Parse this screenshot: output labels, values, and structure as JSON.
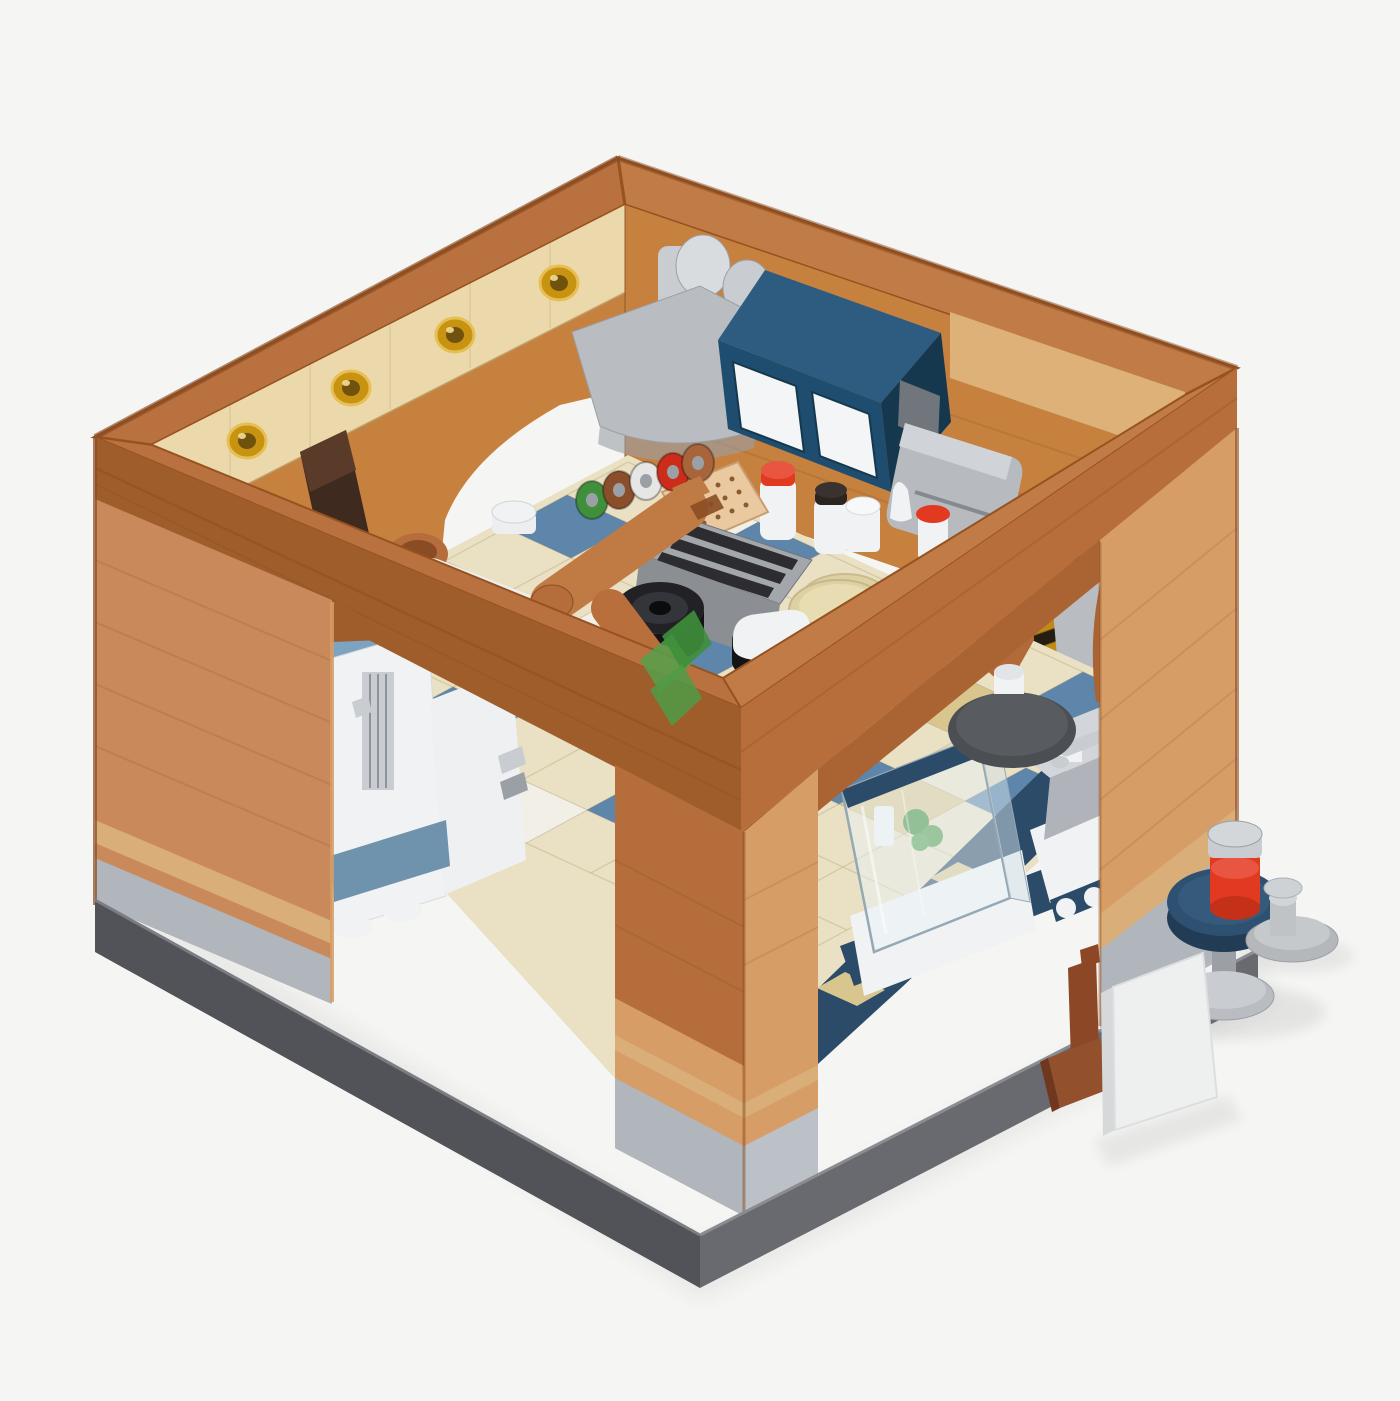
{
  "meta": {
    "alt": "3D product render of a LEGO-style modular building: an open-topped diner kitchen room with caramel brick walls, amber wall lamps, a dark-blue wall cabinet with white doors, chrome extractor hood and chimney, stove with black pots, robotic mixer arm, condiment bottles, glass display case, blue-and-cream checkered tile floor, and an outdoor round navy table with a red cup, a gray stool and a white menu board on a brown stand.",
    "caption": "Brick-built diner kitchen play set, isometric view on a light gray background. No text is visible in the image."
  },
  "palette": {
    "bg": "#f5f5f3",
    "rimTop": "#b97140",
    "rimTopLit": "#c17b46",
    "rimFaceL": "#9f5d2c",
    "rimFaceR": "#b86e3a",
    "rimSub": "#aa6434",
    "rimCap": "#96521f",
    "caramel": "#c9895a",
    "nougat": "#b66d3c",
    "nougatLight": "#d79d66",
    "tanBand": "#ecd9ab",
    "tanStripe": "#d9ae79",
    "tanUpper": "#ddb177",
    "intOrange": "#c6813f",
    "pillarGray": "#b1b6bc",
    "pillarGrayLite": "#bcc1c7",
    "stepGray": "#b9bdc2",
    "grayMid": "#9aa0a6",
    "grayDark": "#70767c",
    "chrome": "#c9ccd0",
    "chromeLite": "#d9dcdf",
    "cabBlue": "#1f4d70",
    "cabBlueTop": "#2e5c80",
    "cabBlueDk": "#15384f",
    "navy": "#2c4b68",
    "navyDk": "#223c55",
    "navyLite": "#2e5171",
    "doorWhite": "#f3f5f6",
    "white": "#f0f2f3",
    "whiteDim": "#e2e5e7",
    "stove": "#8b8e93",
    "stoveTop": "#a3a6ab",
    "stoveDk": "#54575c",
    "potBlack": "#222226",
    "potInner": "#34353b",
    "potDeep": "#141416",
    "cream": "#ddd1a4",
    "creamDk": "#c9bb8e",
    "creamLite": "#e7dcb2",
    "floorCream": "#eae1c4",
    "floorBlue": "#5d86aa",
    "floorWhite": "#f2efe7",
    "floorTan": "#d9c68f",
    "baseL": "#515358",
    "baseR": "#686a70",
    "baseLip": "#7b7d82",
    "blueTop": "#7da3c0",
    "blueTopDk": "#6f93ad",
    "cupRed": "#e23a20",
    "cupRedDk": "#c53118",
    "cupRedLite": "#e85540",
    "sign": "#eef0f0",
    "signSide": "#d6d8d9",
    "standBrown": "#8b4726",
    "standBrownDk": "#6f371d",
    "standBrownLite": "#93502c",
    "green": "#4f9b47",
    "greenDk": "#3f8f3b",
    "greenLite": "#55a04b",
    "amber": "#c89310",
    "amberDk": "#6f520d",
    "amberLite": "#e6bf55",
    "gold": "#c08a18",
    "goldDk": "#8f6410",
    "shutterDk": "#241d12",
    "bag": "#3f2a1f",
    "bagLite": "#5a3a28",
    "turn": "#4b4e53",
    "turnTop": "#585b60",
    "armWhite": "#eceef0",
    "armBrown": "#c07a44",
    "armBrownDk": "#8a4c22",
    "glass": "#e9f1f6",
    "glassSide": "#d4e1e9",
    "glassEdge": "#94a8b6"
  },
  "scene": {
    "objects": [
      "open-top brick room",
      "amber wall lamps",
      "hanging satchel",
      "extractor hood",
      "chimney pipes",
      "blue wall cabinet",
      "coffee machine",
      "condiment bottles",
      "plate rack",
      "strainer panel",
      "stove with pots",
      "mixer arm",
      "dough plate",
      "prep table",
      "bar stool",
      "plant",
      "drink machine",
      "glass display case",
      "sink counter with faucet",
      "turntable pedestal",
      "golden shutter",
      "checkered tile floor",
      "outdoor cafe table",
      "red cup",
      "outdoor stool",
      "menu board",
      "brown board stand"
    ]
  },
  "floor": {
    "origin": [
      628,
      462
    ],
    "u": [
      65,
      30
    ],
    "v": [
      -61,
      33
    ],
    "cols": 9,
    "rows": 7,
    "clip": "628,455 1198,716 700,1172 236,662",
    "tiles": [
      {
        "i": 0,
        "j": 1,
        "c": "blue"
      },
      {
        "i": 1,
        "j": 3,
        "c": "blue"
      },
      {
        "i": 2,
        "j": 5,
        "c": "blue"
      },
      {
        "i": 2,
        "j": 0,
        "c": "blue"
      },
      {
        "i": 3,
        "j": 2,
        "c": "blue"
      },
      {
        "i": 4,
        "j": 4,
        "c": "blue"
      },
      {
        "i": 5,
        "j": 1,
        "c": "blue"
      },
      {
        "i": 6,
        "j": 3,
        "c": "blue"
      },
      {
        "i": 7,
        "j": 0,
        "c": "blue"
      },
      {
        "i": 8,
        "j": 2,
        "c": "blue"
      },
      {
        "i": 3,
        "j": 6,
        "c": "blue"
      },
      {
        "i": 5,
        "j": 5,
        "c": "blue"
      },
      {
        "i": 0,
        "j": 5,
        "c": "white"
      },
      {
        "i": 1,
        "j": 0,
        "c": "white"
      },
      {
        "i": 2,
        "j": 2,
        "c": "white"
      },
      {
        "i": 4,
        "j": 6,
        "c": "white"
      },
      {
        "i": 6,
        "j": 5,
        "c": "white"
      },
      {
        "i": 6,
        "j": 1,
        "c": "tan"
      },
      {
        "i": 7,
        "j": 3,
        "c": "tan"
      },
      {
        "i": 8,
        "j": 0,
        "c": "tan"
      },
      {
        "i": 4,
        "j": 0,
        "c": "tan"
      }
    ]
  },
  "lamps": {
    "centers": [
      [
        247,
        441
      ],
      [
        351,
        388
      ],
      [
        455,
        335
      ],
      [
        559,
        283
      ]
    ]
  },
  "plates": {
    "items": [
      {
        "x": 592,
        "y": 500,
        "color": "#3f8f3b"
      },
      {
        "x": 619,
        "y": 490,
        "color": "#8a4e2a"
      },
      {
        "x": 646,
        "y": 481,
        "color": "#e6e6e4"
      },
      {
        "x": 673,
        "y": 472,
        "color": "#cc2c1a"
      },
      {
        "x": 698,
        "y": 463,
        "color": "#a8643a"
      }
    ]
  }
}
